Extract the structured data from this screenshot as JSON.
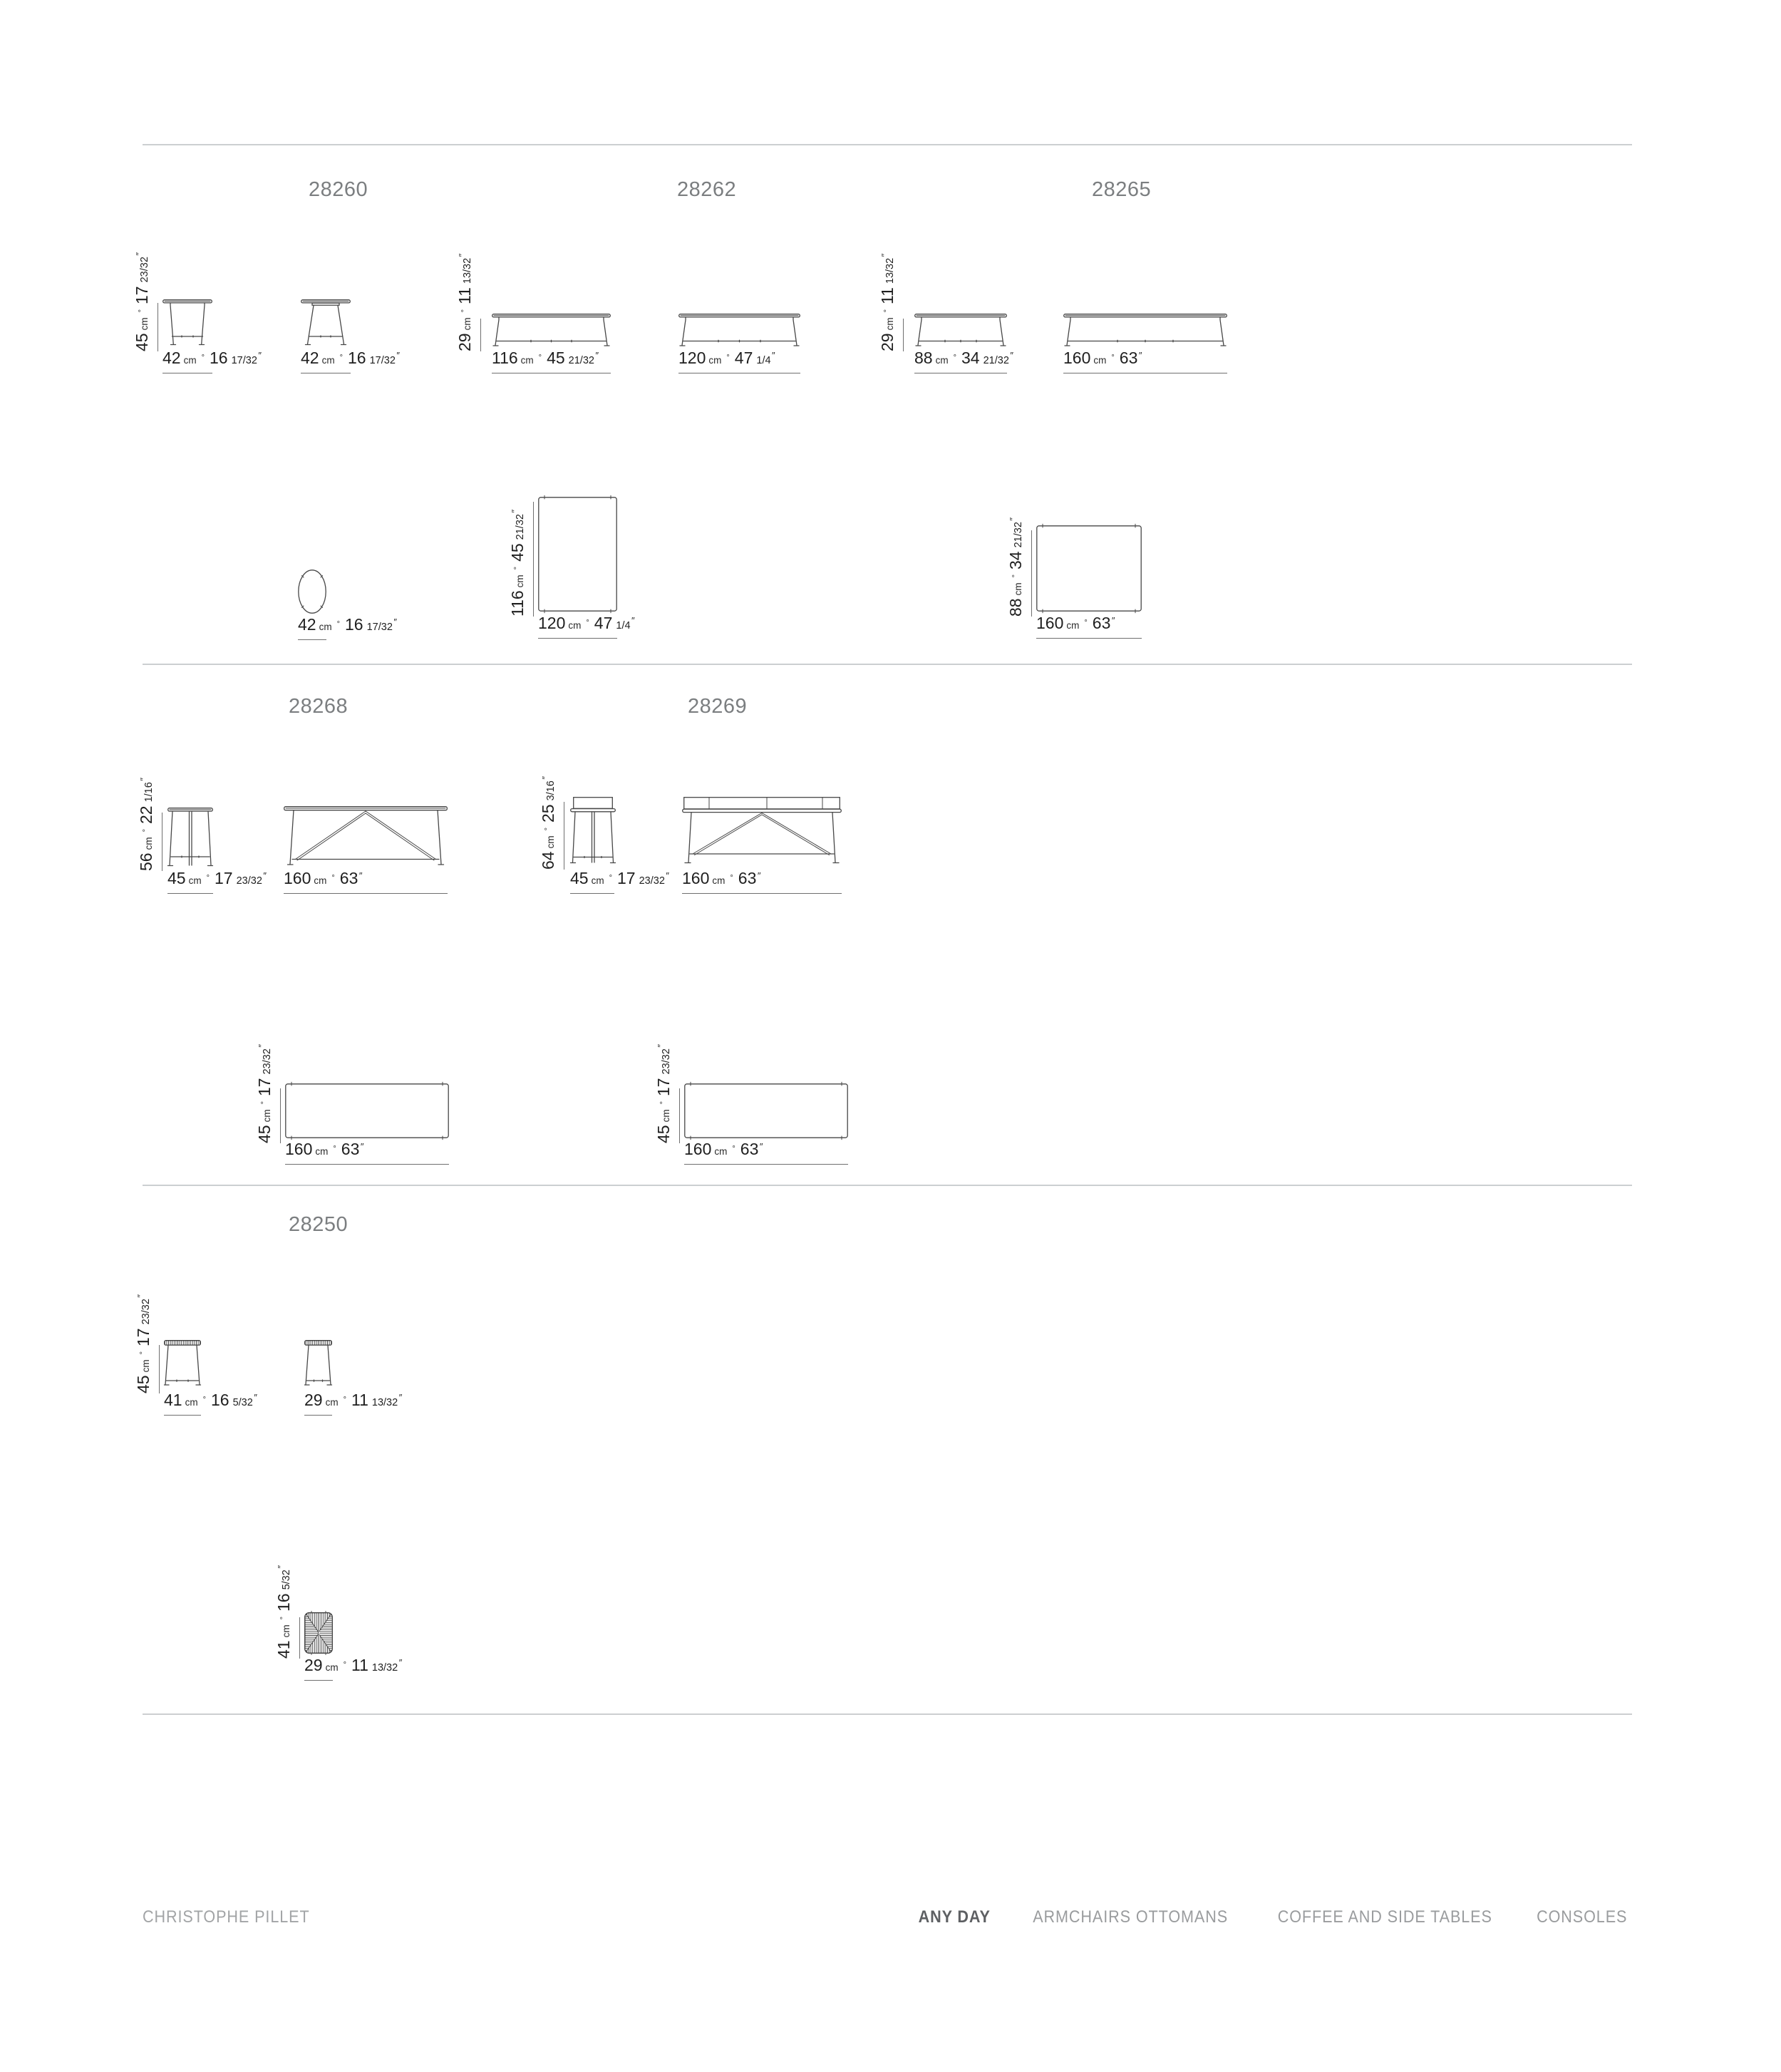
{
  "product_codes": [
    "28260",
    "28262",
    "28265",
    "28268",
    "28269",
    "28250"
  ],
  "units": {
    "cm": "cm",
    "sep": "°",
    "inch_mark": "″"
  },
  "dims": {
    "cm42": {
      "cm": "42",
      "in": "16",
      "frac": "17/32"
    },
    "cm45": {
      "cm": "45",
      "in": "17",
      "frac": "23/32"
    },
    "cm29": {
      "cm": "29",
      "in": "11",
      "frac": "13/32"
    },
    "cm116": {
      "cm": "116",
      "in": "45",
      "frac": "21/32"
    },
    "cm120": {
      "cm": "120",
      "in": "47",
      "frac": "1/4"
    },
    "cm88": {
      "cm": "88",
      "in": "34",
      "frac": "21/32"
    },
    "cm160": {
      "cm": "160",
      "in": "63",
      "frac": ""
    },
    "cm56": {
      "cm": "56",
      "in": "22",
      "frac": "1/16"
    },
    "cm64": {
      "cm": "64",
      "in": "25",
      "frac": "3/16"
    },
    "cm41": {
      "cm": "41",
      "in": "16",
      "frac": "5/32"
    }
  },
  "footer": {
    "designer": "CHRISTOPHE PILLET",
    "collection": "ANY DAY",
    "categories": [
      "ARMCHAIRS OTTOMANS",
      "COFFEE AND SIDE TABLES",
      "CONSOLES"
    ]
  }
}
